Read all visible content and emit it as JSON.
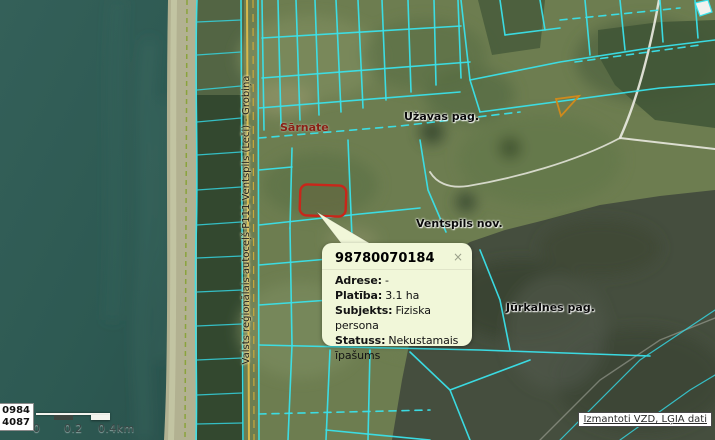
{
  "map": {
    "labels": {
      "sarnate": "Sārnate",
      "uzavas": "Užavas pag.",
      "ventspils": "Ventspils nov.",
      "jurkalnes": "Jūrkalnes pag.",
      "road": "Valsts reģionālais autoceļš P111 Ventspils (Leči) - Grobiņa"
    },
    "colors": {
      "sea": "#2e5b55",
      "parcel_line": "#3ae2ea",
      "selected_parcel": "#c9261a",
      "road_line": "#d6b94b",
      "popup_bg": "#f1f7d9"
    }
  },
  "popup": {
    "title": "98780070184",
    "close_label": "×",
    "fields": [
      {
        "label": "Adrese:",
        "value": "-"
      },
      {
        "label": "Platība:",
        "value": "3.1 ha"
      },
      {
        "label": "Subjekts:",
        "value": "Fiziska persona"
      },
      {
        "label": "Statuss:",
        "value": "Nekustamais īpašums"
      }
    ]
  },
  "scalebar": {
    "tick0": "0",
    "tick1": "0.2",
    "tick2": "0.4km"
  },
  "coordinates": {
    "line1": "0984",
    "line2": "4087"
  },
  "attribution": {
    "link_label": "Izmantoti VZD, LĢIA dati"
  }
}
